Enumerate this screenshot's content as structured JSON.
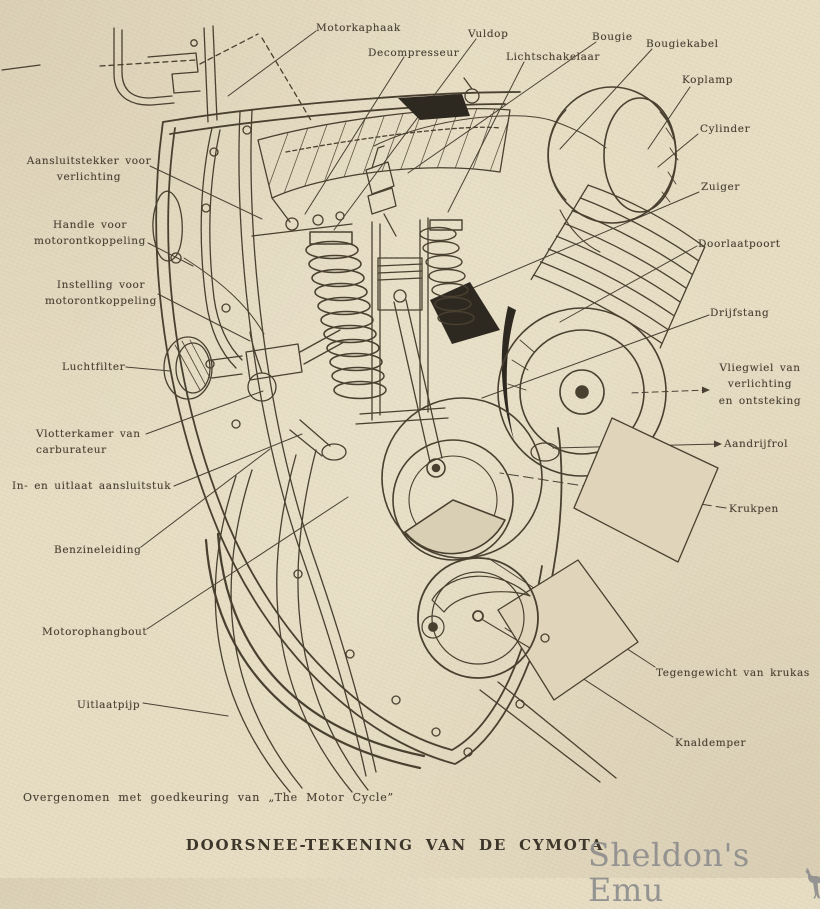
{
  "figure": {
    "caption": "DOORSNEE-TEKENING VAN DE CYMOTA",
    "credit": "Overgenomen met goedkeuring van „The Motor Cycle”",
    "watermark": "Sheldon's Emu"
  },
  "colors": {
    "paper": "#e6dcc2",
    "ink": "#4a4030",
    "watermark_gray": "#8e8e8e"
  },
  "labels": [
    {
      "id": "motorkaphaak",
      "text": "Motorkaphaak"
    },
    {
      "id": "decompresseur",
      "text": "Decompresseur"
    },
    {
      "id": "vuldop",
      "text": "Vuldop"
    },
    {
      "id": "lichtschakelaar",
      "text": "Lichtschakelaar"
    },
    {
      "id": "bougie",
      "text": "Bougie"
    },
    {
      "id": "bougiekabel",
      "text": "Bougiekabel"
    },
    {
      "id": "koplamp",
      "text": "Koplamp"
    },
    {
      "id": "cylinder",
      "text": "Cylinder"
    },
    {
      "id": "zuiger",
      "text": "Zuiger"
    },
    {
      "id": "doorlaatpoort",
      "text": "Doorlaatpoort"
    },
    {
      "id": "drijfstang",
      "text": "Drijfstang"
    },
    {
      "id": "vliegwiel",
      "text": "Vliegwiel van\nverlichting\nen ontsteking"
    },
    {
      "id": "aandrijfrol",
      "text": "Aandrijfrol"
    },
    {
      "id": "krukpen",
      "text": "Krukpen"
    },
    {
      "id": "tegengewicht",
      "text": "Tegengewicht van krukas"
    },
    {
      "id": "knaldemper",
      "text": "Knaldemper"
    },
    {
      "id": "aansluitstekker",
      "text": "Aansluitstekker voor\nverlichting"
    },
    {
      "id": "handle",
      "text": "Handle voor\nmotorontkoppeling"
    },
    {
      "id": "instelling",
      "text": "Instelling voor\nmotorontkoppeling"
    },
    {
      "id": "luchtfilter",
      "text": "Luchtfilter"
    },
    {
      "id": "vlotterkamer",
      "text": "Vlotterkamer van\ncarburateur"
    },
    {
      "id": "in_uitlaat",
      "text": "In- en uitlaat aansluitstuk"
    },
    {
      "id": "benzineleiding",
      "text": "Benzineleiding"
    },
    {
      "id": "motorophangbout",
      "text": "Motorophangbout"
    },
    {
      "id": "uitlaatpijp",
      "text": "Uitlaatpijp"
    }
  ]
}
